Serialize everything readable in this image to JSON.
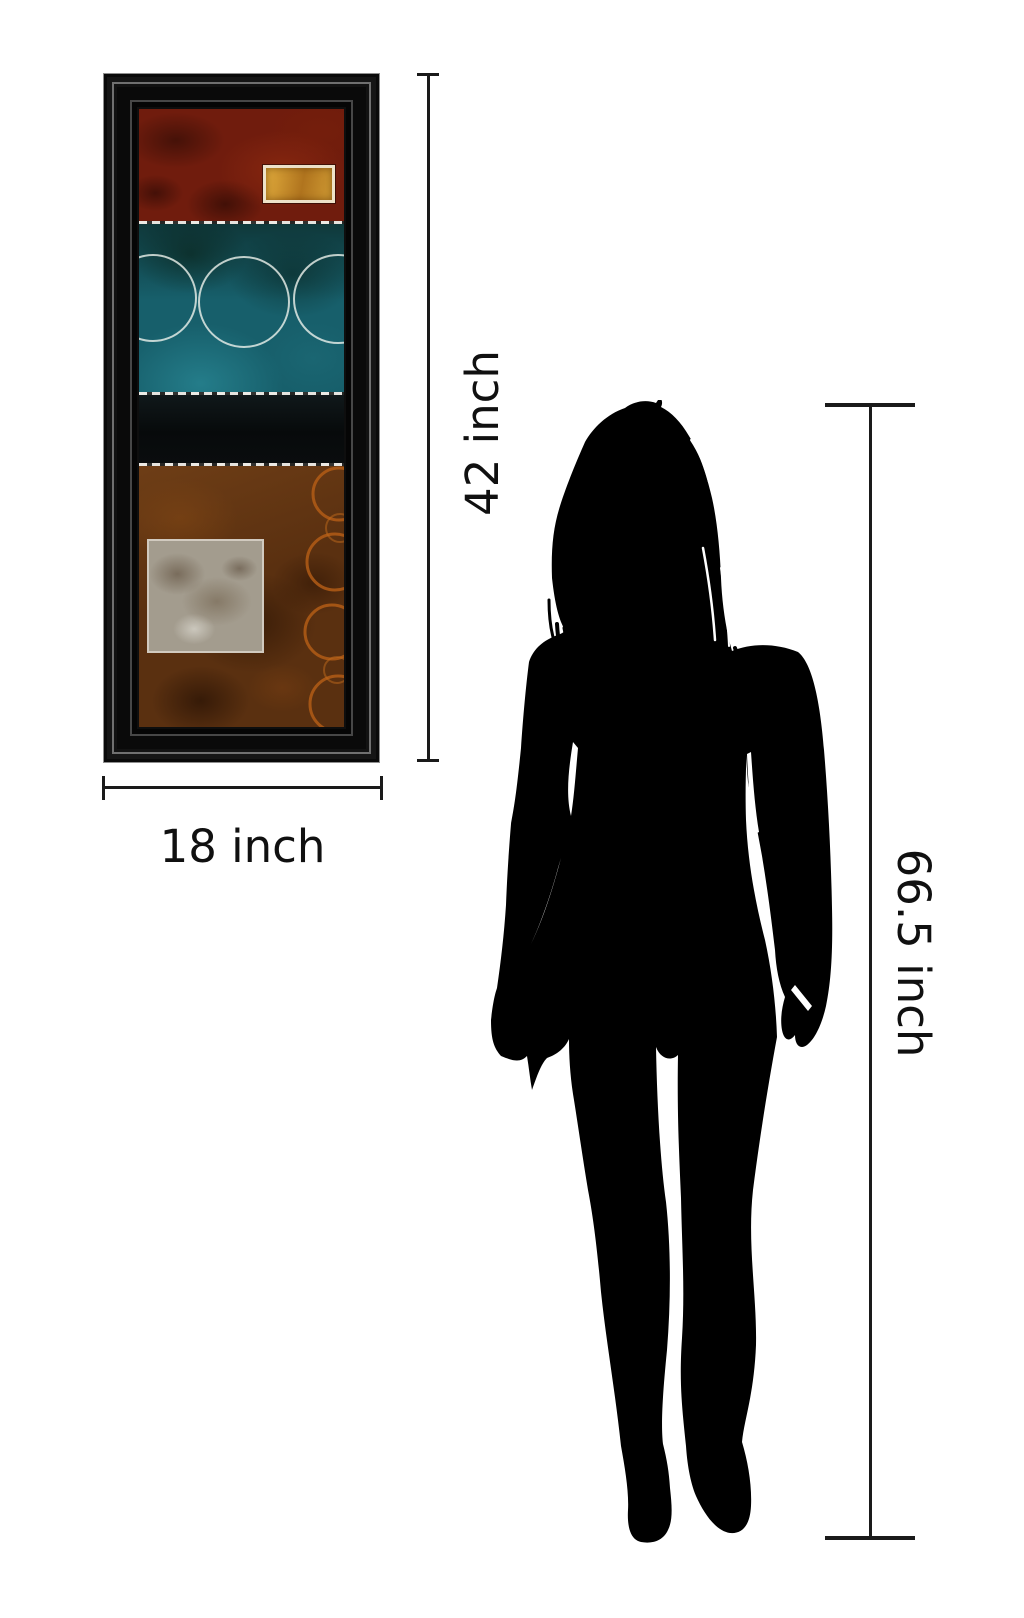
{
  "diagram": {
    "type": "product-size-comparison",
    "background": "#ffffff",
    "line_color": "#1a1a1a",
    "text_color": "#101010"
  },
  "measurements": {
    "artwork_width": {
      "label": "18 inch",
      "value": 18,
      "unit": "inch"
    },
    "artwork_height": {
      "label": "42 inch",
      "value": 42,
      "unit": "inch"
    },
    "person_height": {
      "label": "66.5 inch",
      "value": 66.5,
      "unit": "inch"
    }
  },
  "framed_art": {
    "frame_color": "#0e0e0e",
    "bands": [
      {
        "name": "red",
        "color": "#701c0d"
      },
      {
        "name": "teal",
        "color": "#175f6b"
      },
      {
        "name": "black",
        "color": "#0a0d0e"
      },
      {
        "name": "brown",
        "color": "#5a3010"
      }
    ],
    "accents": {
      "gold_rectangle": "#c8922f",
      "grey_rectangle": "#a39c8e",
      "copper_rings": "#b25c16",
      "circle_outlines": "#eef2ec"
    }
  },
  "silhouette": {
    "color": "#000000"
  }
}
